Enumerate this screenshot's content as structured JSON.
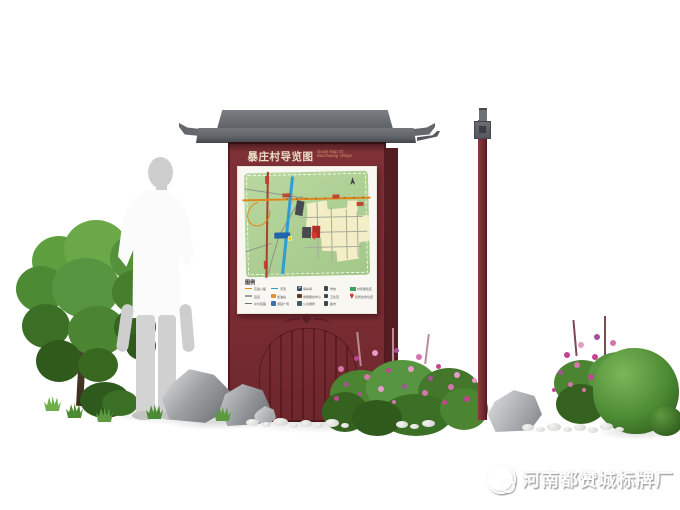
{
  "sign": {
    "title": "暴庄村导览图",
    "subtitle_en": [
      "Guide Map Of",
      "Baozhuang Village"
    ],
    "legend": {
      "title": "图例",
      "columns": [
        [
          {
            "swatch": "line",
            "color": "#e0861a",
            "label": "高速公路"
          },
          {
            "swatch": "line",
            "color": "#9aa095",
            "label": "县道"
          },
          {
            "swatch": "line",
            "color": "#6f7370",
            "label": "乡村道路"
          }
        ],
        [
          {
            "swatch": "line",
            "color": "#2f9cd6",
            "label": "河流"
          },
          {
            "swatch": "icon",
            "color": "#e2922a",
            "label": "加油站"
          },
          {
            "swatch": "icon",
            "color": "#3f6fae",
            "label": "游园广场"
          }
        ],
        [
          {
            "swatch": "icon",
            "color": "#34495e",
            "label": "停车场",
            "glyph": "P"
          },
          {
            "swatch": "icon",
            "color": "#5b3a2e",
            "label": "党群服务中心"
          },
          {
            "swatch": "icon",
            "color": "#455a64",
            "label": "公共厕所"
          }
        ],
        [
          {
            "swatch": "icon",
            "color": "#37474f",
            "label": "学校"
          },
          {
            "swatch": "icon",
            "color": "#37474f",
            "label": "卫生室"
          },
          {
            "swatch": "icon",
            "color": "#37474f",
            "label": "超市"
          }
        ],
        [
          {
            "swatch": "rect",
            "color": "#3da35a",
            "label": "村民居住区"
          },
          {
            "swatch": "pin",
            "color": "#d0392d",
            "label": "您所在的位置"
          }
        ]
      ]
    },
    "colors": {
      "board_maroon": "#7a2d33",
      "roof_gray": "#64686c",
      "map_green": "#aecd93",
      "highway_orange": "#e0861a",
      "river_blue": "#2f9cd6",
      "village_cream": "#f3eec6",
      "marker_red": "#d0392d"
    }
  },
  "watermark": {
    "factory_name": "河南都赞城标牌厂"
  }
}
